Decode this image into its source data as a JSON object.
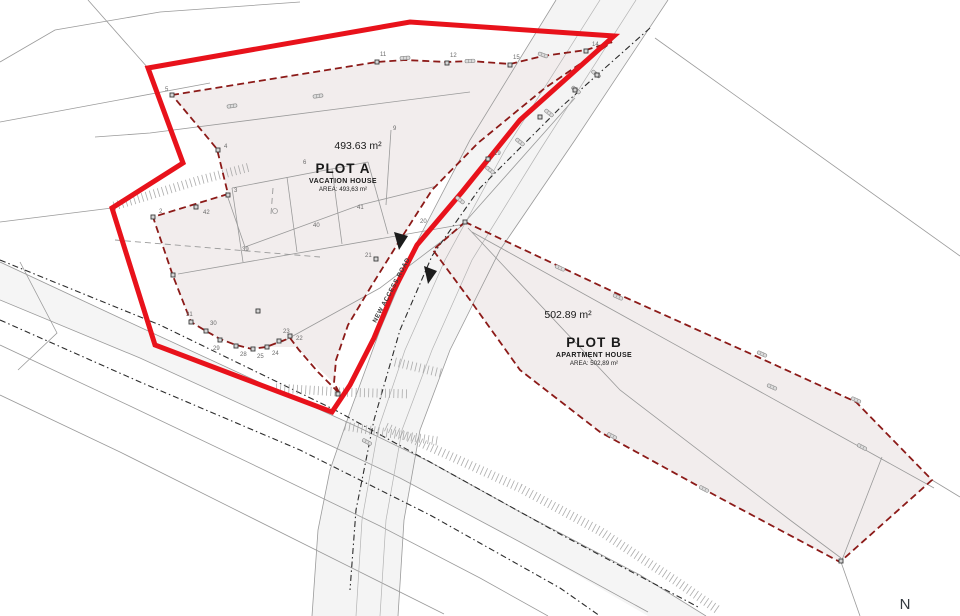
{
  "drawing": {
    "plot_a": {
      "area_label": "493.63 m²",
      "name": "PLOT A",
      "type": "VACATION HOUSE",
      "area_note": "AREA: 493,63 m²"
    },
    "plot_b": {
      "area_label": "502.89 m²",
      "name": "PLOT B",
      "type": "APARTMENT HOUSE",
      "area_note": "AREA: 502,89 m²"
    },
    "road_label": "NEW ACCESS ROAD",
    "north_label": "N",
    "colors": {
      "site_boundary_red": "#e8121b",
      "parcel_boundary_dark_red": "#8c1a18",
      "plot_fill": "#f2eded",
      "road_fill": "#ececec",
      "survey_line_gray": "#9a9a9a",
      "text_dark": "#1a1a1a"
    },
    "survey_points": [
      {
        "label": "5",
        "x": 172,
        "y": 95,
        "lx": 165,
        "ly": 91
      },
      {
        "label": "4",
        "x": 218,
        "y": 150,
        "lx": 224,
        "ly": 148
      },
      {
        "label": "3",
        "x": 228,
        "y": 195,
        "lx": 234,
        "ly": 192
      },
      {
        "label": "2",
        "x": 153,
        "y": 217,
        "lx": 159,
        "ly": 213
      },
      {
        "label": "42",
        "x": 196,
        "y": 207,
        "lx": 203,
        "ly": 214
      },
      {
        "label": "39",
        "m": false,
        "lx": 242,
        "ly": 251
      },
      {
        "label": "40",
        "m": false,
        "lx": 313,
        "ly": 227
      },
      {
        "label": "41",
        "m": false,
        "lx": 357,
        "ly": 209
      },
      {
        "label": "6",
        "m": false,
        "lx": 303,
        "ly": 164
      },
      {
        "label": "9",
        "m": false,
        "lx": 393,
        "ly": 130
      },
      {
        "label": "11",
        "x": 377,
        "y": 62,
        "lx": 380,
        "ly": 56
      },
      {
        "label": "12",
        "x": 447,
        "y": 63,
        "lx": 450,
        "ly": 57
      },
      {
        "label": "15",
        "x": 510,
        "y": 65,
        "lx": 513,
        "ly": 59
      },
      {
        "label": "14",
        "x": 586,
        "y": 51,
        "lx": 592,
        "ly": 46
      },
      {
        "label": "19",
        "x": 488,
        "y": 159,
        "lx": 494,
        "ly": 155
      },
      {
        "label": "20",
        "m": false,
        "lx": 420,
        "ly": 223
      },
      {
        "label": "21",
        "x": 376,
        "y": 259,
        "lx": 365,
        "ly": 257
      },
      {
        "label": "31",
        "x": 191,
        "y": 322,
        "lx": 186,
        "ly": 316
      },
      {
        "label": "30",
        "x": 206,
        "y": 331,
        "lx": 210,
        "ly": 325
      },
      {
        "label": "29",
        "x": 220,
        "y": 340,
        "lx": 213,
        "ly": 350
      },
      {
        "label": "28",
        "x": 236,
        "y": 346,
        "lx": 240,
        "ly": 356
      },
      {
        "label": "25",
        "x": 253,
        "y": 349,
        "lx": 257,
        "ly": 358
      },
      {
        "label": "24",
        "x": 267,
        "y": 347,
        "lx": 272,
        "ly": 355
      },
      {
        "label": "23",
        "x": 279,
        "y": 341,
        "lx": 283,
        "ly": 333
      },
      {
        "label": "22",
        "x": 290,
        "y": 336,
        "lx": 296,
        "ly": 340
      },
      {
        "label": "",
        "x": 597,
        "y": 75
      },
      {
        "label": "",
        "x": 575,
        "y": 90
      },
      {
        "label": "",
        "x": 540,
        "y": 117
      },
      {
        "label": "",
        "x": 173,
        "y": 275
      },
      {
        "label": "",
        "x": 338,
        "y": 394
      },
      {
        "label": "",
        "x": 465,
        "y": 222
      },
      {
        "label": "",
        "x": 841,
        "y": 561
      },
      {
        "label": "",
        "x": 258,
        "y": 311
      }
    ],
    "fence_markers": [
      {
        "x": 232,
        "y": 106,
        "a": -8
      },
      {
        "x": 318,
        "y": 96,
        "a": -8
      },
      {
        "x": 405,
        "y": 58,
        "a": -4
      },
      {
        "x": 470,
        "y": 61,
        "a": -3
      },
      {
        "x": 543,
        "y": 55,
        "a": 20
      },
      {
        "x": 596,
        "y": 74,
        "a": 38
      },
      {
        "x": 576,
        "y": 90,
        "a": 38
      },
      {
        "x": 549,
        "y": 113,
        "a": 38
      },
      {
        "x": 520,
        "y": 142,
        "a": 38
      },
      {
        "x": 490,
        "y": 170,
        "a": 38
      },
      {
        "x": 460,
        "y": 200,
        "a": 38
      },
      {
        "x": 560,
        "y": 268,
        "a": 24
      },
      {
        "x": 618,
        "y": 297,
        "a": 24
      },
      {
        "x": 762,
        "y": 354,
        "a": 24
      },
      {
        "x": 856,
        "y": 400,
        "a": 24
      },
      {
        "x": 772,
        "y": 387,
        "a": 24
      },
      {
        "x": 862,
        "y": 447,
        "a": 28
      },
      {
        "x": 612,
        "y": 436,
        "a": 28
      },
      {
        "x": 704,
        "y": 489,
        "a": 28
      },
      {
        "x": 367,
        "y": 442,
        "a": 28
      }
    ]
  }
}
